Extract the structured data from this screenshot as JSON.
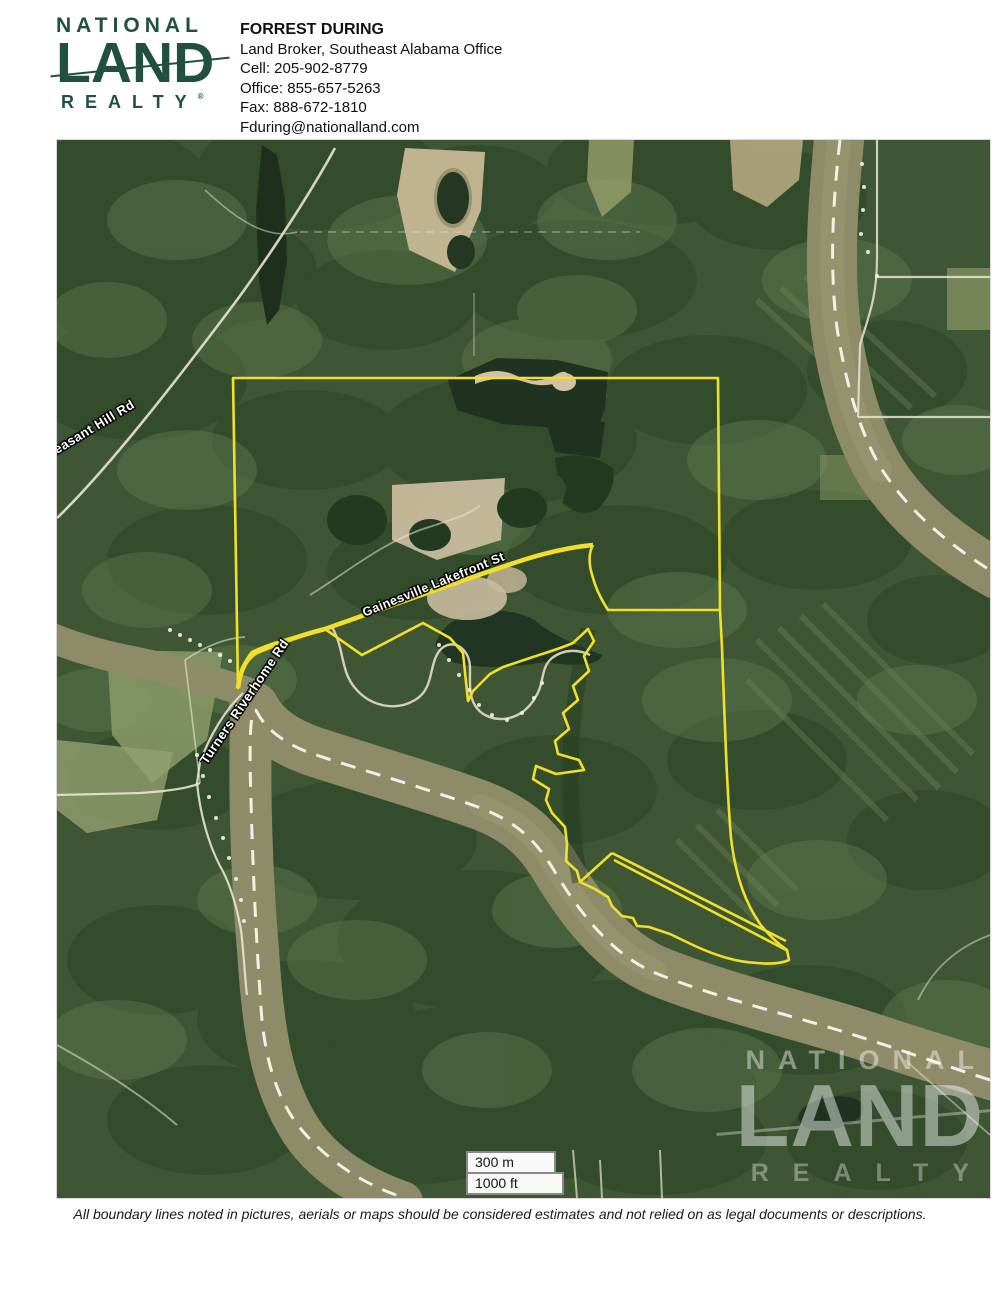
{
  "header": {
    "logo": {
      "line1": "NATIONAL",
      "line2": "LAND",
      "line3": "REALTY",
      "registered": "®"
    },
    "contact": {
      "name": "FORREST DURING",
      "title": "Land Broker, Southeast Alabama Office",
      "cell": "Cell: 205-902-8779",
      "office": "Office: 855-657-5263",
      "fax": "Fax: 888-672-1810",
      "email": "Fduring@nationalland.com"
    }
  },
  "map": {
    "road_labels": {
      "pleasant": "t Pleasant Hill Rd",
      "turners": "Turners Riverhome Rd",
      "gainesville": "Gainesville Lakefront St"
    },
    "scale": {
      "metric": "300 m",
      "imperial": "1000 ft"
    },
    "watermark": {
      "line1": "NATIONAL",
      "line2": "LAND",
      "line3": "REALTY"
    },
    "colors": {
      "boundary_yellow": "#F2DF2A",
      "forest_green": "#3E5634",
      "river_olive": "#8E8C68",
      "road_white": "#ECE8DC",
      "logo_green": "#21503F"
    }
  },
  "footer": {
    "disclaimer": "All boundary lines noted in pictures, aerials or maps should be considered estimates and not relied on as legal documents or descriptions."
  }
}
